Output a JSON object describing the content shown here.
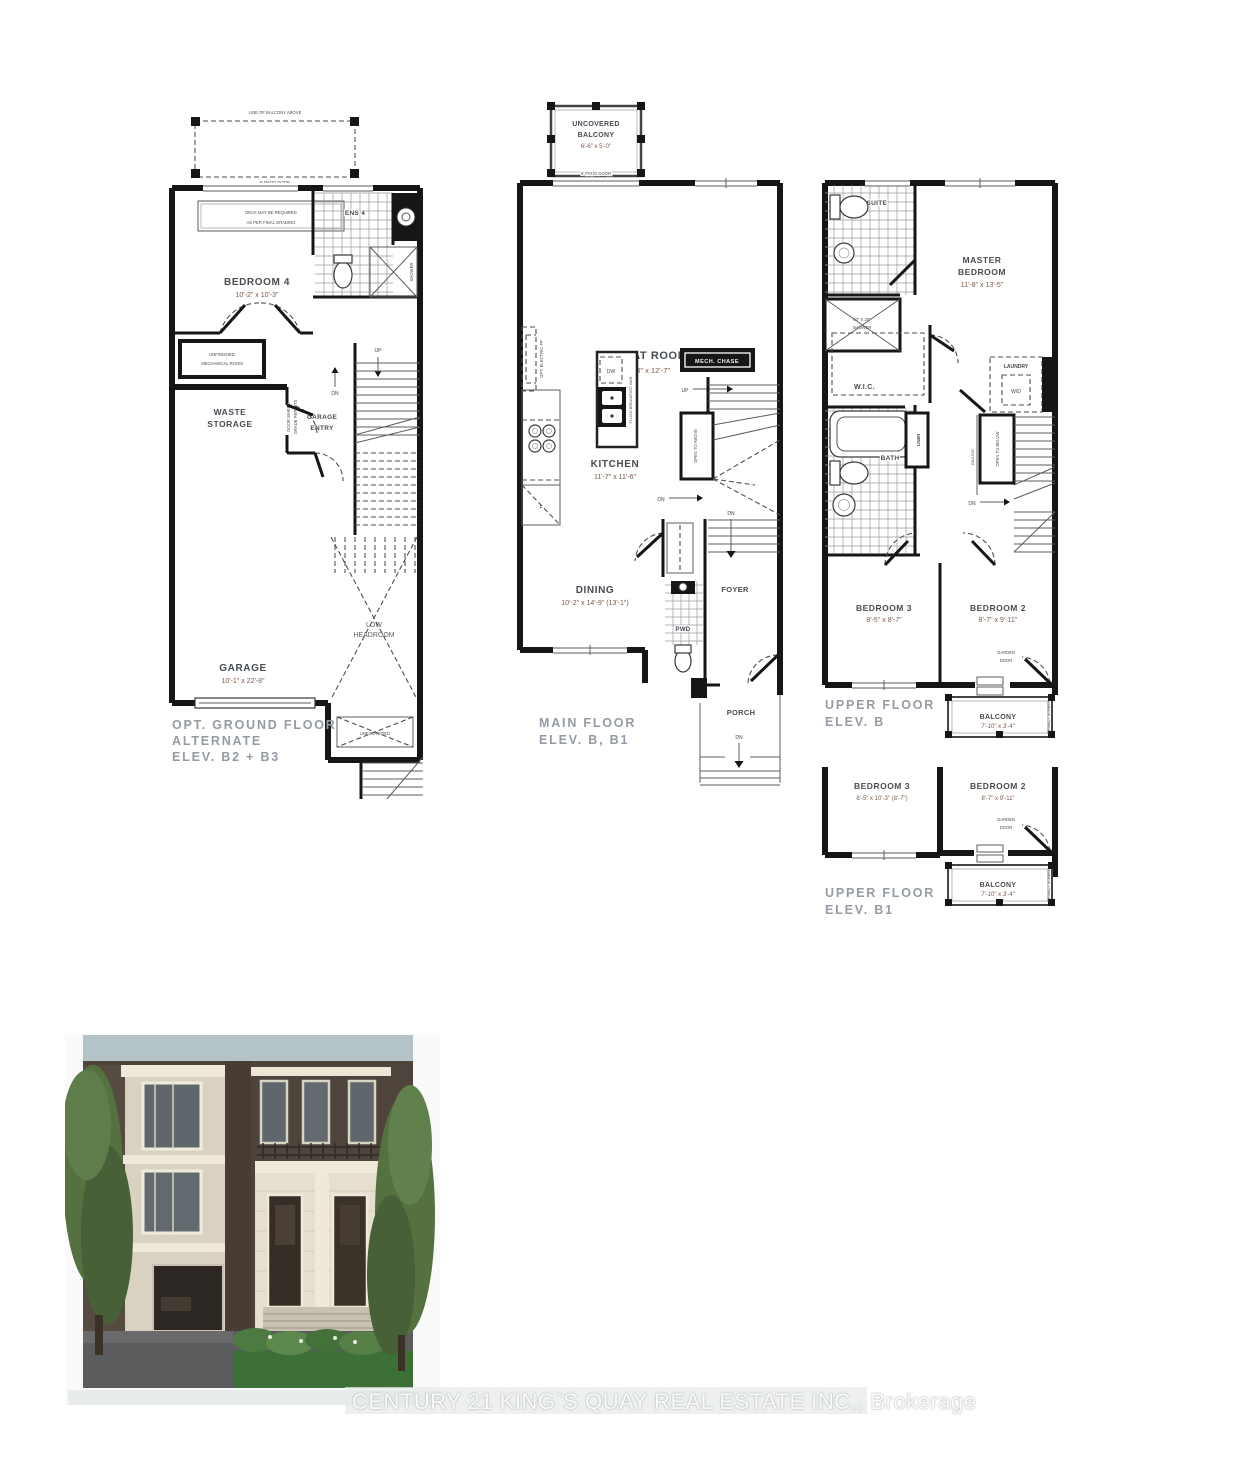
{
  "watermark": "CENTURY 21 KING`S QUAY REAL ESTATE INC., Brokerage",
  "ground": {
    "line_of_balcony": "LINE OF BALCONY ABOVE",
    "patio_door": "8' PATIO DOOR",
    "deck_note_1": "DECK MAY BE REQUIRED",
    "deck_note_2": "AS PER FINAL GRADING",
    "ens4": "ENS 4",
    "shower_note": "SHOWER",
    "bedroom4": "BEDROOM 4",
    "bedroom4_dim": "10'-2\" x 10'-3\"",
    "mech_1": "UNFINISHED",
    "mech_2": "MECHANICAL ROOM",
    "waste_1": "WASTE",
    "waste_2": "STORAGE",
    "door_grade_1": "DOOR WHERE",
    "door_grade_2": "GRADE PERMITS",
    "garage_entry_1": "GARAGE",
    "garage_entry_2": "ENTRY",
    "up": "UP",
    "dn": "DN",
    "garage": "GARAGE",
    "garage_dim": "10'-1\" x 22'-8\"",
    "low_1": "LOW",
    "low_2": "HEADROOM",
    "unexcavated": "UNEXCAVATED",
    "caption_1": "OPT. GROUND FLOOR",
    "caption_2": "ALTERNATE",
    "caption_3": "ELEV. B2 + B3"
  },
  "main": {
    "balcony_1": "UNCOVERED",
    "balcony_2": "BALCONY",
    "balcony_dim": "6'-6\" x 5'-0\"",
    "patio_door": "5' PATIO DOOR",
    "great_room": "GREAT ROOM",
    "great_room_dim": "17'-4\" x 12'-7\"",
    "opt_fp": "OPT. ELECTRIC FP",
    "mech_chase": "MECH. CHASE",
    "dw": "DW",
    "fridge": "F",
    "flush_bar": "FLUSH BREAKFAST BAR",
    "kitchen": "KITCHEN",
    "kitchen_dim": "11'-7\" x 11'-6\"",
    "open_above": "OPEN TO ABOVE",
    "up": "UP",
    "dn1": "DN",
    "dn2": "DN",
    "dn3": "DN",
    "dining": "DINING",
    "dining_dim": "10'-2\" x 14'-9\" (13'-1\")",
    "pwd": "PWD",
    "foyer": "FOYER",
    "porch": "PORCH",
    "caption_1": "MAIN FLOOR",
    "caption_2": "ELEV. B, B1"
  },
  "upper_b": {
    "ensuite": "ENSUITE",
    "shower_1": "60\" X 30\"",
    "shower_2": "SHOWER",
    "master_1": "MASTER",
    "master_2": "BEDROOM",
    "master_dim": "11'-8\" x 13'-5\"",
    "wic": "W.I.C.",
    "laundry": "LAUNDRY",
    "wd": "W/D",
    "bath": "BATH",
    "linen": "LINEN",
    "railing": "RAILING",
    "open_below": "OPEN TO BELOW",
    "dn": "DN",
    "bedroom3": "BEDROOM 3",
    "bedroom3_dim": "8'-5\" x 8'-7\"",
    "bedroom2": "BEDROOM 2",
    "bedroom2_dim": "8'-7\" x 9'-11\"",
    "garden_1": "GARDEN",
    "garden_2": "DOOR",
    "balcony": "BALCONY",
    "balcony_dim": "7'-10\" x 3'-4\"",
    "privacy": "PRIVACY SCREEN",
    "caption_1": "UPPER FLOOR",
    "caption_2": "ELEV. B"
  },
  "upper_b1": {
    "bedroom3": "BEDROOM 3",
    "bedroom3_dim": "8'-5\" x 10'-3\" (8'-7\")",
    "bedroom2": "BEDROOM 2",
    "bedroom2_dim": "8'-7\" x 9'-11\"",
    "garden_1": "GARDEN",
    "garden_2": "DOOR",
    "balcony": "BALCONY",
    "balcony_dim": "7'-10\" x 3'-4\"",
    "privacy": "PRIVACY SCREEN",
    "caption_1": "UPPER FLOOR",
    "caption_2": "ELEV. B1"
  }
}
